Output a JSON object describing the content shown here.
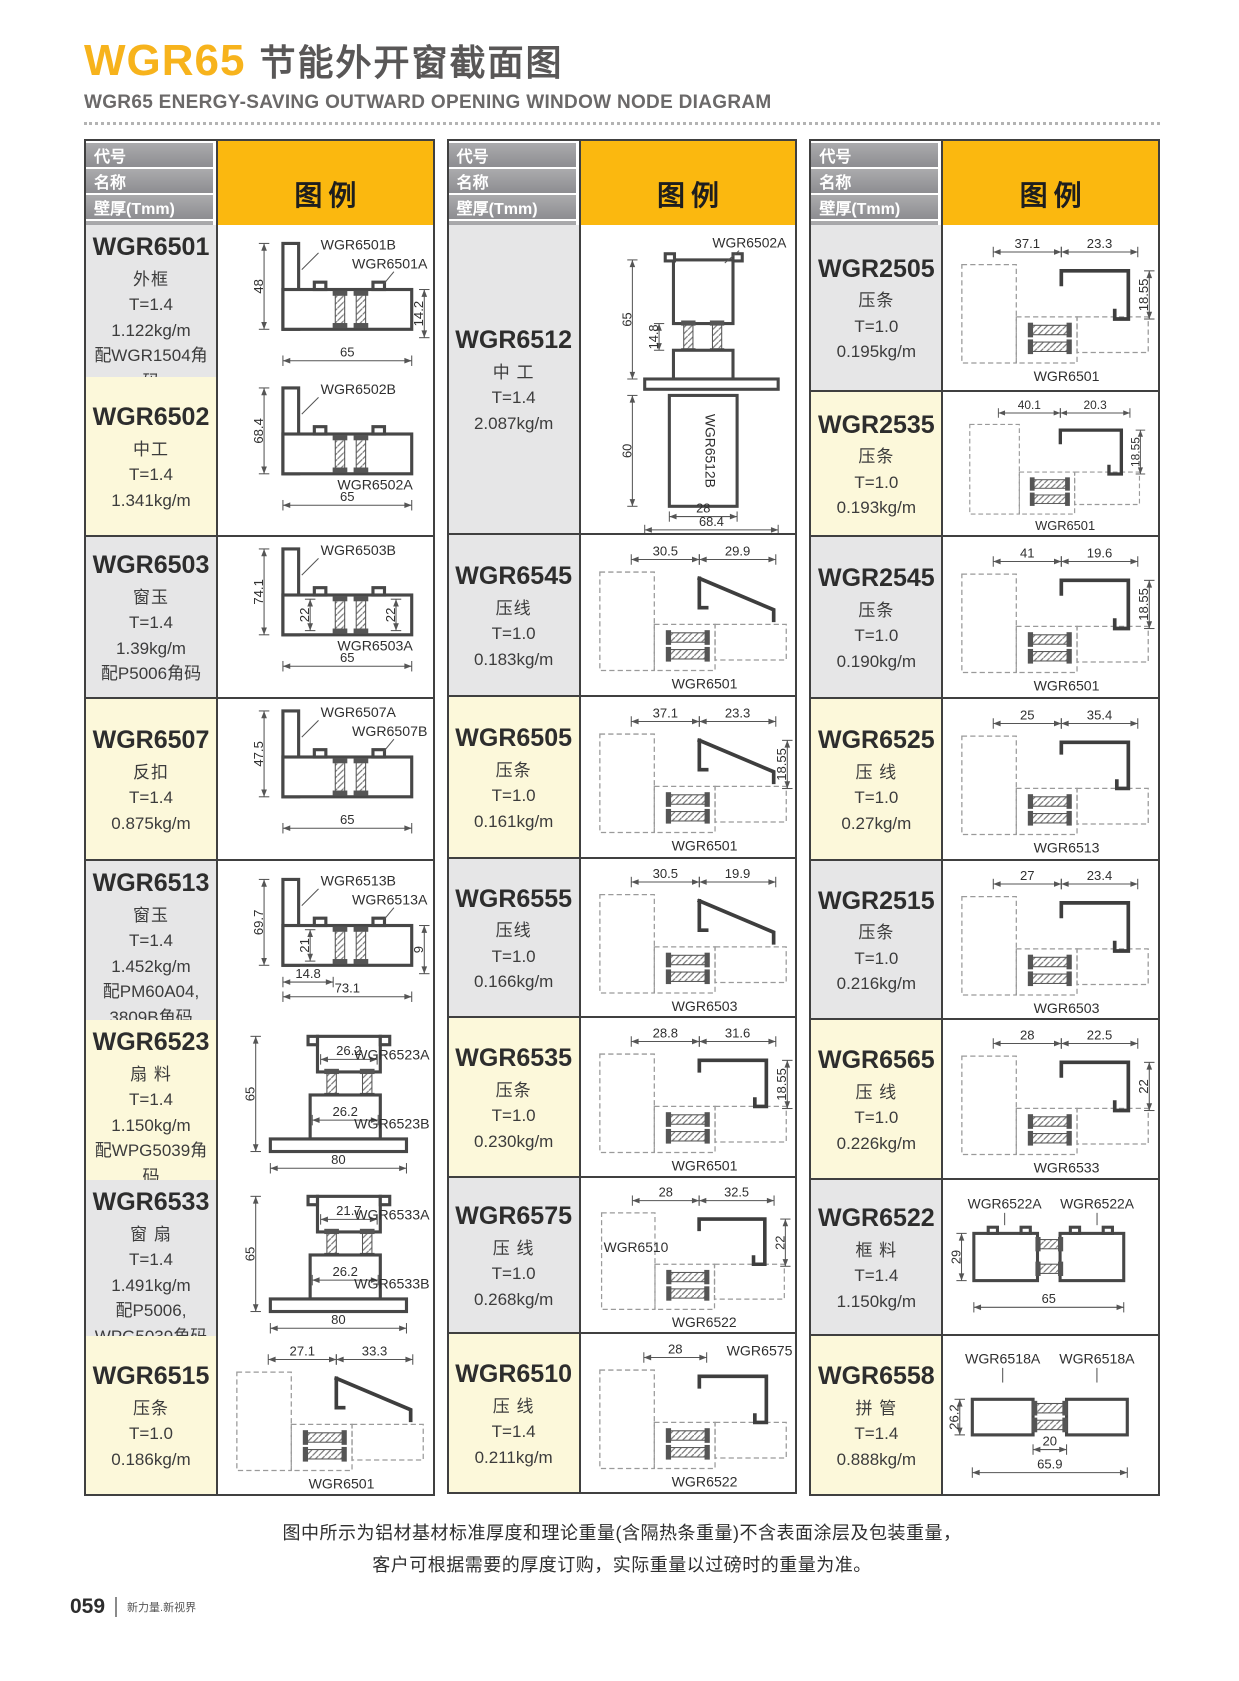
{
  "page": {
    "title_code": "WGR65",
    "title_cn": "节能外开窗截面图",
    "subtitle": "WGR65 ENERGY-SAVING OUTWARD OPENING WINDOW NODE DIAGRAM",
    "footnote_line1": "图中所示为铝材基材标准厚度和理论重量(含隔热条重量)不含表面涂层及包装重量，",
    "footnote_line2": "客户可根据需要的厚度订购，实际重量以过磅时的重量为准。",
    "page_number": "059",
    "page_tagline": "新力量.新视界"
  },
  "colors": {
    "accent_yellow": "#fbb80f",
    "title_yellow": "#f7b31c",
    "header_bar_gray": "#98989c",
    "cell_gray": "#e6e6e7",
    "cell_cream": "#fcf8da",
    "border_dark": "#404040"
  },
  "table_header": {
    "cells": [
      "代号",
      "名称",
      "壁厚(Tmm)",
      "重量(kg/m)"
    ],
    "legend": "图例"
  },
  "tables": [
    {
      "rows": [
        {
          "code": "WGR6501",
          "name": "外框",
          "t": "T=1.4",
          "w": "1.122kg/m",
          "extra": [
            "配WGR1504角码"
          ],
          "bg": "gray",
          "h": 150,
          "diagram": {
            "type": "frame",
            "dims": {
              "left": "48",
              "bottom": "65",
              "right": "14.2"
            },
            "labels": [
              {
                "text": "WGR6501B",
                "slot": "top1"
              },
              {
                "text": "WGR6501A",
                "slot": "top2"
              }
            ]
          }
        },
        {
          "code": "WGR6502",
          "name": "中工",
          "t": "T=1.4",
          "w": "1.341kg/m",
          "extra": [],
          "bg": "cream",
          "h": 158,
          "diagram": {
            "type": "frame",
            "dims": {
              "left": "68.4",
              "bottom": "65"
            },
            "labels": [
              {
                "text": "WGR6502B",
                "slot": "top1"
              },
              {
                "text": "WGR6502A",
                "slot": "botR"
              }
            ]
          }
        },
        {
          "code": "WGR6503",
          "name": "窗玉",
          "t": "T=1.4",
          "w": "1.39kg/m",
          "extra": [
            "配P5006角码"
          ],
          "bg": "gray",
          "h": 160,
          "diagram": {
            "type": "frame",
            "dims": {
              "left": "74.1",
              "bottom": "65",
              "innerL": "22",
              "innerR": "22"
            },
            "labels": [
              {
                "text": "WGR6503B",
                "slot": "top1"
              },
              {
                "text": "WGR6503A",
                "slot": "botR"
              }
            ]
          }
        },
        {
          "code": "WGR6507",
          "name": "反扣",
          "t": "T=1.4",
          "w": "0.875kg/m",
          "extra": [],
          "bg": "cream",
          "h": 160,
          "diagram": {
            "type": "frame",
            "dims": {
              "left": "47.5",
              "bottom": "65"
            },
            "labels": [
              {
                "text": "WGR6507A",
                "slot": "top1"
              },
              {
                "text": "WGR6507B",
                "slot": "top2"
              }
            ]
          }
        },
        {
          "code": "WGR6513",
          "name": "窗玉",
          "t": "T=1.4",
          "w": "1.452kg/m",
          "extra": [
            "配PM60A04,",
            "3809B角码"
          ],
          "bg": "gray",
          "h": 157,
          "diagram": {
            "type": "frame",
            "dims": {
              "left": "69.7",
              "bottom": "73.1",
              "right": "9",
              "innerL": "21",
              "innerB": "14.8"
            },
            "labels": [
              {
                "text": "WGR6513B",
                "slot": "top1"
              },
              {
                "text": "WGR6513A",
                "slot": "top2"
              }
            ]
          }
        },
        {
          "code": "WGR6523",
          "name": "扇 料",
          "t": "T=1.4",
          "w": "1.150kg/m",
          "extra": [
            "配WPG5039角码"
          ],
          "bg": "cream",
          "h": 158,
          "diagram": {
            "type": "sash",
            "dims": {
              "left": "65",
              "bottom": "80",
              "innerT": "26.2",
              "innerM": "26.2"
            },
            "labels": [
              {
                "text": "WGR6523A",
                "slot": "r1"
              },
              {
                "text": "WGR6523B",
                "slot": "r2"
              }
            ]
          }
        },
        {
          "code": "WGR6533",
          "name": "窗 扇",
          "t": "T=1.4",
          "w": "1.491kg/m",
          "extra": [
            "配P5006,",
            "WPG5039角码"
          ],
          "bg": "gray",
          "h": 154,
          "diagram": {
            "type": "sash",
            "dims": {
              "left": "65",
              "bottom": "80",
              "innerT": "21.7",
              "innerM": "26.2"
            },
            "labels": [
              {
                "text": "WGR6533A",
                "slot": "r1"
              },
              {
                "text": "WGR6533B",
                "slot": "r2"
              }
            ]
          }
        },
        {
          "code": "WGR6515",
          "name": "压条",
          "t": "T=1.0",
          "w": "0.186kg/m",
          "extra": [],
          "bg": "cream",
          "h": 158,
          "diagram": {
            "type": "bead",
            "variant": "tri",
            "dims": {
              "top1": "27.1",
              "top2": "33.3"
            },
            "labels": [
              {
                "text": "WGR6501",
                "slot": "bottom"
              }
            ]
          }
        }
      ]
    },
    {
      "rows": [
        {
          "code": "WGR6512",
          "name": "中 工",
          "t": "T=1.4",
          "w": "2.087kg/m",
          "extra": [],
          "bg": "gray",
          "h": 308,
          "diagram": {
            "type": "mullion",
            "dims": {
              "left1": "65",
              "left2": "60",
              "innerL": "14.8",
              "bottom1": "28",
              "bottom2": "68.4"
            },
            "labels": [
              {
                "text": "WGR6502A",
                "slot": "top"
              },
              {
                "text": "WGR6512B",
                "slot": "inner"
              }
            ]
          }
        },
        {
          "code": "WGR6545",
          "name": "压线",
          "t": "T=1.0",
          "w": "0.183kg/m",
          "extra": [],
          "bg": "gray",
          "h": 160,
          "diagram": {
            "type": "bead",
            "variant": "tri",
            "dims": {
              "top1": "30.5",
              "top2": "29.9"
            },
            "labels": [
              {
                "text": "WGR6501",
                "slot": "bottom"
              }
            ]
          }
        },
        {
          "code": "WGR6505",
          "name": "压条",
          "t": "T=1.0",
          "w": "0.161kg/m",
          "extra": [],
          "bg": "cream",
          "h": 160,
          "diagram": {
            "type": "bead",
            "variant": "tri",
            "dims": {
              "top1": "37.1",
              "top2": "23.3",
              "right": "18.55"
            },
            "labels": [
              {
                "text": "WGR6501",
                "slot": "bottom"
              }
            ]
          }
        },
        {
          "code": "WGR6555",
          "name": "压线",
          "t": "T=1.0",
          "w": "0.166kg/m",
          "extra": [],
          "bg": "gray",
          "h": 157,
          "diagram": {
            "type": "bead",
            "variant": "tri",
            "dims": {
              "top1": "30.5",
              "top2": "19.9"
            },
            "labels": [
              {
                "text": "WGR6503",
                "slot": "bottom"
              }
            ]
          }
        },
        {
          "code": "WGR6535",
          "name": "压条",
          "t": "T=1.0",
          "w": "0.230kg/m",
          "extra": [],
          "bg": "cream",
          "h": 158,
          "diagram": {
            "type": "bead",
            "variant": "L",
            "dims": {
              "top1": "28.8",
              "top2": "31.6",
              "right": "18.55"
            },
            "labels": [
              {
                "text": "WGR6501",
                "slot": "bottom"
              }
            ]
          }
        },
        {
          "code": "WGR6575",
          "name": "压 线",
          "t": "T=1.0",
          "w": "0.268kg/m",
          "extra": [],
          "bg": "gray",
          "h": 154,
          "diagram": {
            "type": "bead",
            "variant": "L",
            "dims": {
              "top1": "28",
              "top2": "32.5",
              "right": "22"
            },
            "labels": [
              {
                "text": "WGR6510",
                "slot": "leftMid"
              },
              {
                "text": "WGR6522",
                "slot": "bottom"
              }
            ]
          }
        },
        {
          "code": "WGR6510",
          "name": "压 线",
          "t": "T=1.4",
          "w": "0.211kg/m",
          "extra": [],
          "bg": "cream",
          "h": 158,
          "diagram": {
            "type": "bead",
            "variant": "L",
            "dims": {
              "top1": "28"
            },
            "labels": [
              {
                "text": "WGR6575",
                "slot": "topRight"
              },
              {
                "text": "WGR6522",
                "slot": "bottom"
              }
            ]
          }
        }
      ]
    },
    {
      "rows": [
        {
          "code": "WGR2505",
          "name": "压条",
          "t": "T=1.0",
          "w": "0.195kg/m",
          "extra": [],
          "bg": "gray",
          "h": 165,
          "diagram": {
            "type": "bead",
            "variant": "box",
            "dims": {
              "top1": "37.1",
              "top2": "23.3",
              "right": "18.55"
            },
            "labels": [
              {
                "text": "WGR6501",
                "slot": "bottom"
              }
            ]
          }
        },
        {
          "code": "WGR2535",
          "name": "压条",
          "t": "T=1.0",
          "w": "0.193kg/m",
          "extra": [],
          "bg": "cream",
          "h": 143,
          "diagram": {
            "type": "bead",
            "variant": "box",
            "dims": {
              "top1": "40.1",
              "top2": "20.3",
              "right": "18.55"
            },
            "labels": [
              {
                "text": "WGR6501",
                "slot": "bottom"
              }
            ]
          }
        },
        {
          "code": "WGR2545",
          "name": "压条",
          "t": "T=1.0",
          "w": "0.190kg/m",
          "extra": [],
          "bg": "gray",
          "h": 160,
          "diagram": {
            "type": "bead",
            "variant": "box",
            "dims": {
              "top1": "41",
              "top2": "19.6",
              "right": "18.55"
            },
            "labels": [
              {
                "text": "WGR6501",
                "slot": "bottom"
              }
            ]
          }
        },
        {
          "code": "WGR6525",
          "name": "压 线",
          "t": "T=1.0",
          "w": "0.27kg/m",
          "extra": [],
          "bg": "cream",
          "h": 160,
          "diagram": {
            "type": "bead",
            "variant": "L",
            "dims": {
              "top1": "25",
              "top2": "35.4"
            },
            "labels": [
              {
                "text": "WGR6513",
                "slot": "bottom"
              }
            ]
          }
        },
        {
          "code": "WGR2515",
          "name": "压条",
          "t": "T=1.0",
          "w": "0.216kg/m",
          "extra": [],
          "bg": "gray",
          "h": 157,
          "diagram": {
            "type": "bead",
            "variant": "box",
            "dims": {
              "top1": "27",
              "top2": "23.4"
            },
            "labels": [
              {
                "text": "WGR6503",
                "slot": "bottom"
              }
            ]
          }
        },
        {
          "code": "WGR6565",
          "name": "压 线",
          "t": "T=1.0",
          "w": "0.226kg/m",
          "extra": [],
          "bg": "cream",
          "h": 158,
          "diagram": {
            "type": "bead",
            "variant": "box",
            "dims": {
              "top1": "28",
              "top2": "22.5",
              "right": "22"
            },
            "labels": [
              {
                "text": "WGR6533",
                "slot": "bottom"
              }
            ]
          }
        },
        {
          "code": "WGR6522",
          "name": "框 料",
          "t": "T=1.4",
          "w": "1.150kg/m",
          "extra": [],
          "bg": "gray",
          "h": 154,
          "diagram": {
            "type": "tube",
            "variant": "tube",
            "dims": {
              "left": "29",
              "bottom": "65"
            },
            "labels": [
              {
                "text": "WGR6522A",
                "slot": "t1"
              },
              {
                "text": "WGR6522A",
                "slot": "t2"
              }
            ]
          }
        },
        {
          "code": "WGR6558",
          "name": "拼 管",
          "t": "T=1.4",
          "w": "0.888kg/m",
          "extra": [],
          "bg": "cream",
          "h": 158,
          "diagram": {
            "type": "tube",
            "variant": "tube2",
            "dims": {
              "left": "26.2",
              "bottom1": "20",
              "bottom2": "65.9"
            },
            "labels": [
              {
                "text": "WGR6518A",
                "slot": "t1"
              },
              {
                "text": "WGR6518A",
                "slot": "t2"
              }
            ]
          }
        }
      ]
    }
  ]
}
